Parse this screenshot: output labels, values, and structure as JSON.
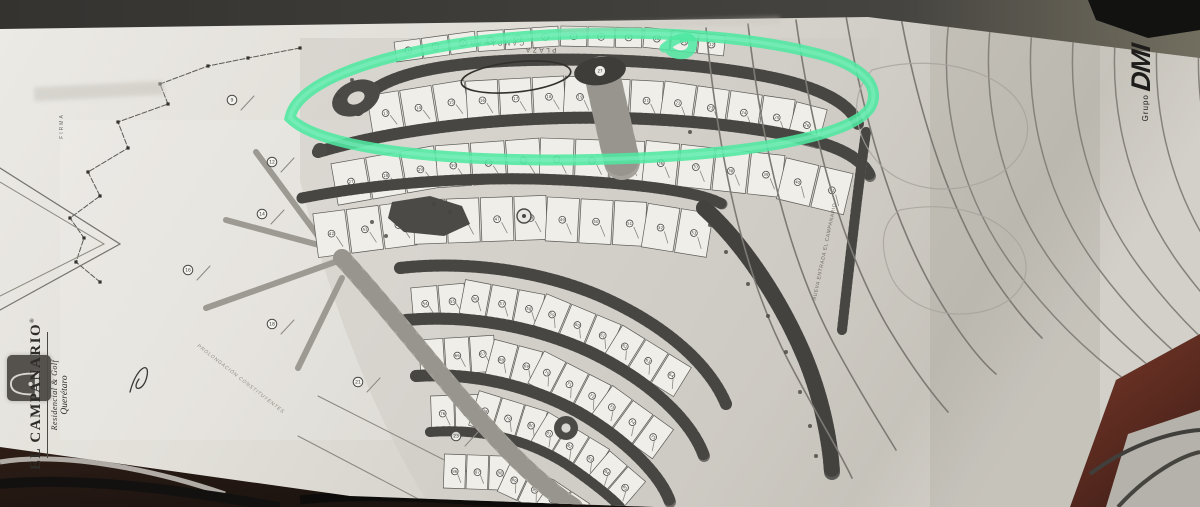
{
  "colors": {
    "marker_green": "#4ee8a1",
    "marker_green_light": "#8af2c6",
    "pen_ink": "#33312d",
    "paper": "#dcd9d3",
    "map_ink": "#4a4845",
    "road_dark": "#6e6c67",
    "road_light": "#a5a29b",
    "desk_strip": "#3a3734",
    "desk_wood": "#6b3226",
    "desk_shadow": "#221713"
  },
  "plan": {
    "title": {
      "plaza": "PLAZA",
      "campanario": "CAMPANARIO"
    },
    "labels": {
      "firma": "FIRMA",
      "road_right": "NUEVA ENTRADA EL CAMPANARIO",
      "road_diagonal": "PROLONGACIÓN CONSTITUYENTES",
      "roundabout_number": "27"
    },
    "logo": {
      "name": "EL CAMPANARIO",
      "reg": "®",
      "subtitle": "Residencial & Golf",
      "city": "Querétaro"
    },
    "brand": {
      "small": "Grupo",
      "big": "DMI"
    },
    "blocks": [
      {
        "name": "top-row",
        "start": 1,
        "count": 12
      },
      {
        "name": "loop-row",
        "start": 13,
        "count": 14
      },
      {
        "name": "second-row",
        "start": 27,
        "count": 15
      },
      {
        "name": "mid-row",
        "start": 42,
        "count": 12
      },
      {
        "name": "fan-row-1",
        "start": 54,
        "count": 11
      },
      {
        "name": "fan-row-2",
        "start": 65,
        "count": 11
      },
      {
        "name": "fan-row-3",
        "start": 76,
        "count": 10
      },
      {
        "name": "fan-row-4",
        "start": 86,
        "count": 7
      }
    ],
    "parcels": [
      {
        "n": "9"
      },
      {
        "n": "12"
      },
      {
        "n": "14"
      },
      {
        "n": "16"
      },
      {
        "n": "18"
      },
      {
        "n": "21"
      },
      {
        "n": "23"
      }
    ]
  }
}
